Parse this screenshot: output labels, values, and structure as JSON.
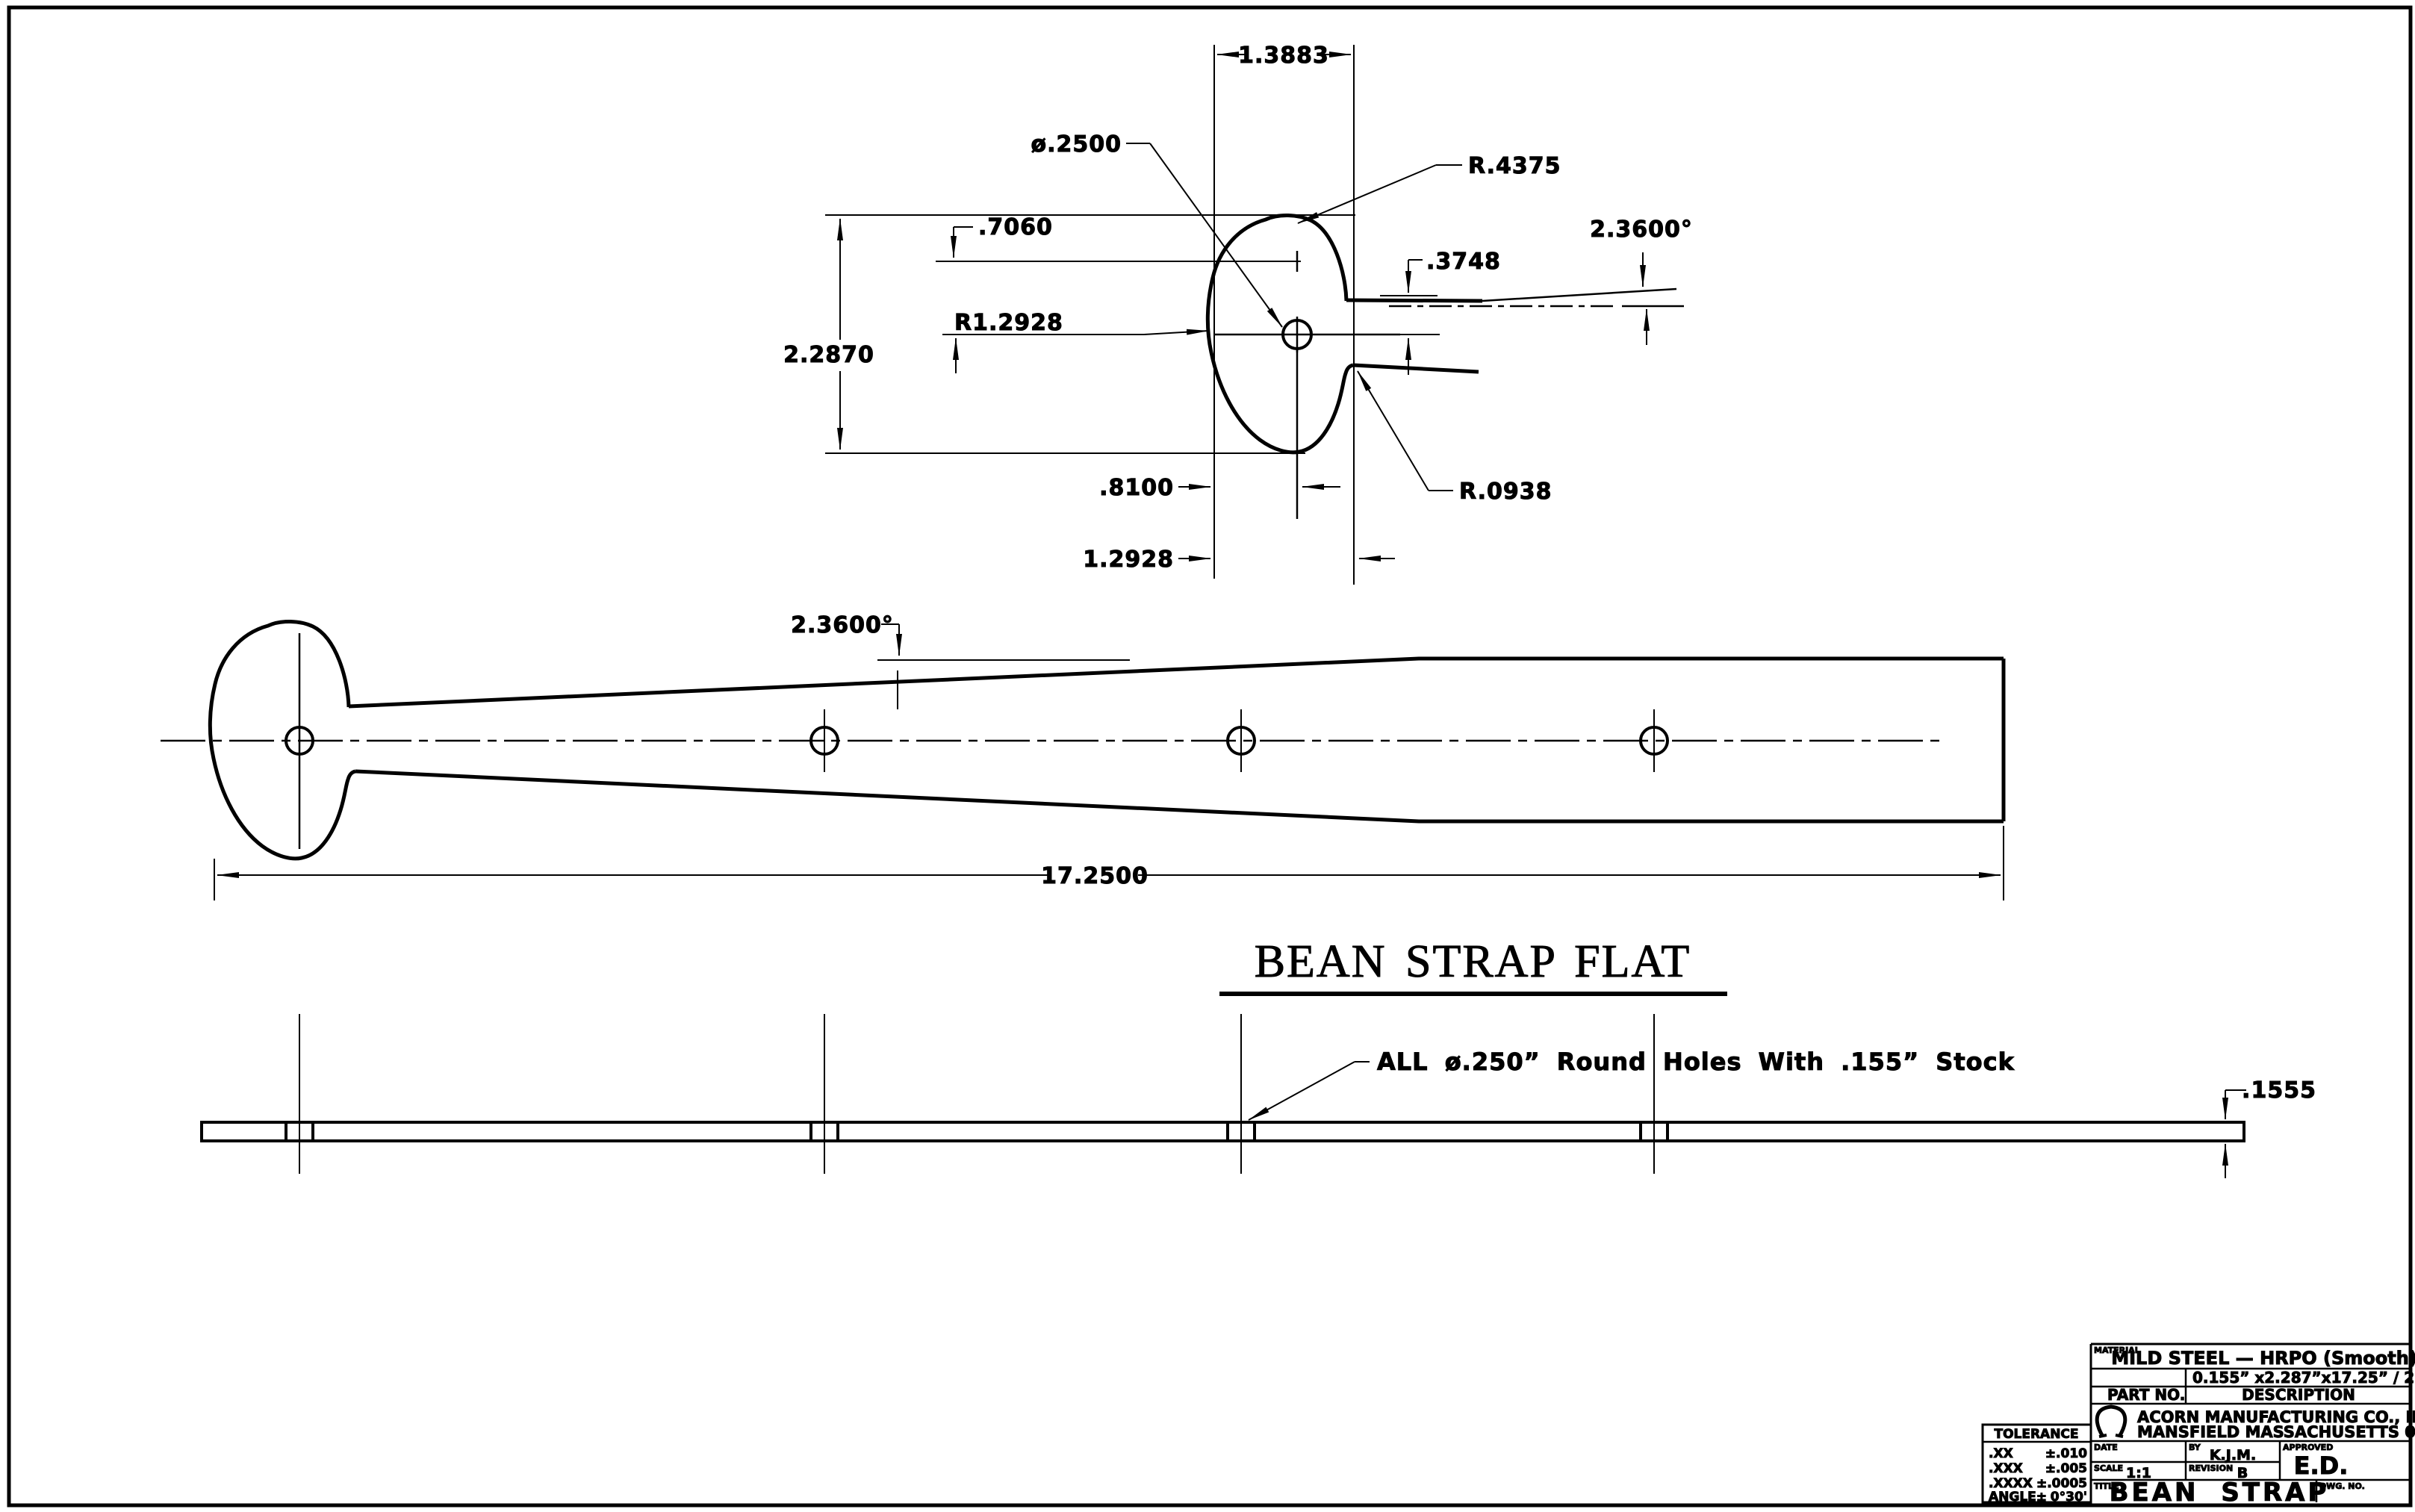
{
  "detail": {
    "head_width": "1.3883",
    "lobe_radius": "R.4375",
    "hole_dia": "ø.2500",
    "lobe_offset": ".7060",
    "head_height": "2.2870",
    "main_radius": "R1.2928",
    "edge_to_center": ".3748",
    "taper_angle": "2.3600°",
    "hole_offset": ".8100",
    "notch_offset": "1.2928",
    "notch_radius": "R.0938"
  },
  "flat": {
    "taper_angle": "2.3600°",
    "length": "17.2500",
    "caption": "BEAN STRAP FLAT"
  },
  "edge": {
    "note": "ALL ø.250” Round Holes With .155” Stock",
    "thickness": ".1555"
  },
  "title_block": {
    "material_label": "MATERIAL",
    "material": "MILD STEEL — HRPO (Smooth)",
    "stock_size": "0.155” x2.287”x17.25” / 21.25”",
    "part_no_label": "PART NO.",
    "description_label": "DESCRIPTION",
    "company_line1": "ACORN MANUFACTURING CO., INC.",
    "company_line2": "MANSFIELD MASSACHUSETTS 02048",
    "date_label": "DATE",
    "by_label": "BY",
    "by": "K.J.M.",
    "approved_label": "APPROVED",
    "approved": "E.D.",
    "scale_label": "SCALE",
    "scale": "1:1",
    "revision_label": "REVISION",
    "revision": "B",
    "title_label": "TITLE",
    "title": "BEAN STRAP",
    "dwg_label": "DWG. NO."
  },
  "tolerance": {
    "header": "TOLERANCE",
    "rows": [
      {
        "label": ".XX",
        "value": "±.010"
      },
      {
        "label": ".XXX",
        "value": "±.005"
      },
      {
        "label": ".XXXX",
        "value": "±.0005"
      },
      {
        "label": "ANGLE±",
        "value": "0°30'"
      }
    ]
  }
}
